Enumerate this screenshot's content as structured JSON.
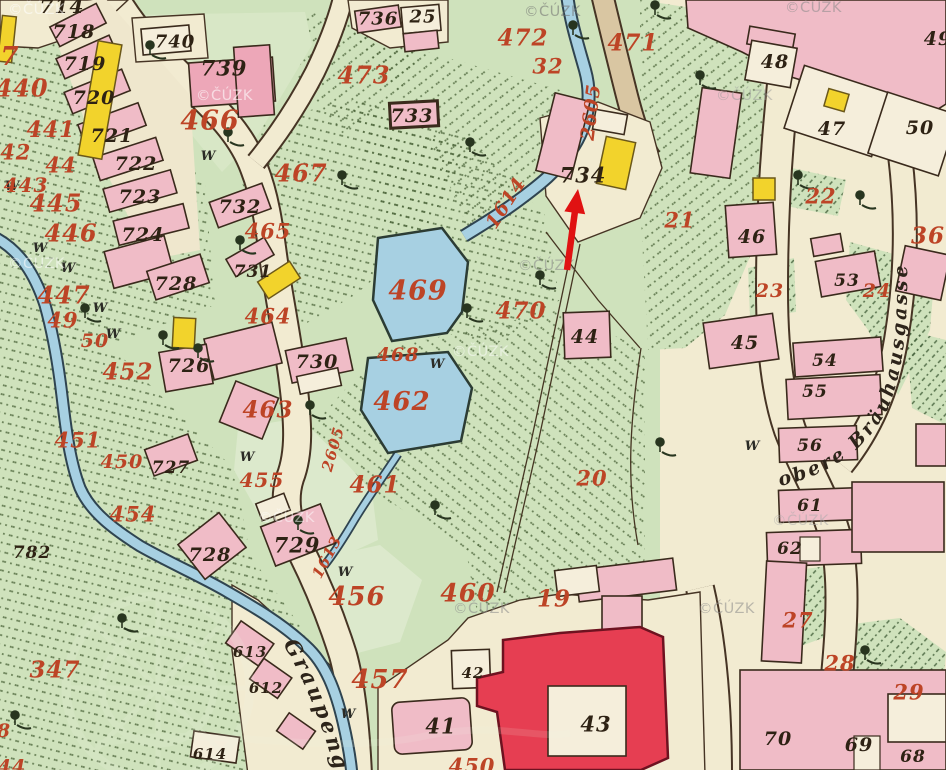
{
  "map": {
    "source_watermark_text": "©ČÚZK",
    "street_names": {
      "graupengasse": "Graupengasse",
      "brauhausgasse": "obere Bräuhausgasse"
    },
    "red_parcel_labels": [
      [
        "7",
        10,
        57,
        26
      ],
      [
        "440",
        22,
        88,
        24
      ],
      [
        "441",
        51,
        130,
        22
      ],
      [
        "442",
        8,
        152,
        21
      ],
      [
        "44",
        61,
        165,
        21
      ],
      [
        "443",
        26,
        185,
        20
      ],
      [
        "445",
        56,
        203,
        24
      ],
      [
        "446",
        71,
        233,
        24
      ],
      [
        "447",
        64,
        295,
        24
      ],
      [
        "49",
        63,
        320,
        21
      ],
      [
        "50",
        95,
        341,
        19
      ],
      [
        "452",
        128,
        372,
        23
      ],
      [
        "451",
        78,
        440,
        21
      ],
      [
        "450",
        122,
        462,
        19
      ],
      [
        "455",
        262,
        480,
        20
      ],
      [
        "454",
        133,
        514,
        21
      ],
      [
        "456",
        357,
        597,
        26
      ],
      [
        "457",
        380,
        680,
        26
      ],
      [
        "460",
        468,
        593,
        25
      ],
      [
        "461",
        375,
        485,
        23
      ],
      [
        "462",
        402,
        402,
        26
      ],
      [
        "463",
        268,
        410,
        23
      ],
      [
        "464",
        268,
        316,
        21
      ],
      [
        "465",
        268,
        231,
        21
      ],
      [
        "466",
        210,
        121,
        27
      ],
      [
        "467",
        301,
        173,
        24
      ],
      [
        "468",
        398,
        355,
        19
      ],
      [
        "469",
        418,
        291,
        27
      ],
      [
        "470",
        521,
        311,
        23
      ],
      [
        "471",
        633,
        43,
        23
      ],
      [
        "472",
        523,
        38,
        23
      ],
      [
        "473",
        364,
        75,
        24
      ],
      [
        "32",
        548,
        66,
        21
      ],
      [
        "2605",
        591,
        112,
        19,
        -83
      ],
      [
        "1614",
        506,
        203,
        19,
        -57
      ],
      [
        "1613",
        327,
        557,
        15,
        -62
      ],
      [
        "2605",
        333,
        449,
        15,
        -74
      ],
      [
        "19",
        554,
        599,
        23
      ],
      [
        "20",
        592,
        478,
        21
      ],
      [
        "21",
        680,
        220,
        21
      ],
      [
        "22",
        821,
        196,
        21
      ],
      [
        "23",
        770,
        291,
        19
      ],
      [
        "24",
        877,
        291,
        19
      ],
      [
        "36",
        928,
        236,
        23
      ],
      [
        "27",
        798,
        620,
        21
      ],
      [
        "28",
        840,
        663,
        21
      ],
      [
        "29",
        909,
        692,
        21
      ],
      [
        "347",
        55,
        670,
        23
      ],
      [
        "450",
        472,
        766,
        21
      ],
      [
        "8",
        4,
        731,
        19
      ],
      [
        "44",
        12,
        767,
        19
      ]
    ],
    "black_house_labels": [
      [
        "714",
        62,
        6,
        20
      ],
      [
        "718",
        74,
        32,
        19
      ],
      [
        "719",
        85,
        64,
        19
      ],
      [
        "720",
        94,
        98,
        19
      ],
      [
        "721",
        112,
        136,
        19
      ],
      [
        "722",
        136,
        164,
        19
      ],
      [
        "723",
        140,
        197,
        19
      ],
      [
        "724",
        143,
        235,
        19
      ],
      [
        "726",
        189,
        366,
        19
      ],
      [
        "727",
        171,
        468,
        17
      ],
      [
        "728",
        176,
        284,
        19
      ],
      [
        "728",
        210,
        555,
        19
      ],
      [
        "739",
        224,
        68,
        21
      ],
      [
        "729",
        297,
        545,
        21
      ],
      [
        "730",
        317,
        362,
        19
      ],
      [
        "731",
        253,
        272,
        17
      ],
      [
        "732",
        240,
        207,
        19
      ],
      [
        "733",
        412,
        116,
        19
      ],
      [
        "734",
        583,
        175,
        21
      ],
      [
        "736",
        378,
        19,
        18
      ],
      [
        "25",
        423,
        17,
        18
      ],
      [
        "740",
        175,
        42,
        18
      ],
      [
        "41",
        441,
        726,
        21
      ],
      [
        "42",
        473,
        673,
        15
      ],
      [
        "43",
        596,
        724,
        21
      ],
      [
        "44",
        585,
        337,
        19
      ],
      [
        "45",
        745,
        343,
        19
      ],
      [
        "46",
        752,
        237,
        19
      ],
      [
        "47",
        832,
        129,
        19
      ],
      [
        "48",
        775,
        62,
        19
      ],
      [
        "49",
        938,
        39,
        19
      ],
      [
        "50",
        920,
        128,
        19
      ],
      [
        "53",
        847,
        281,
        17
      ],
      [
        "54",
        825,
        361,
        17
      ],
      [
        "55",
        815,
        392,
        17
      ],
      [
        "56",
        810,
        446,
        17
      ],
      [
        "61",
        810,
        506,
        17
      ],
      [
        "62",
        790,
        549,
        17
      ],
      [
        "68",
        913,
        757,
        17
      ],
      [
        "69",
        859,
        745,
        19
      ],
      [
        "70",
        778,
        739,
        19
      ],
      [
        "613",
        250,
        652,
        15
      ],
      [
        "612",
        266,
        688,
        15
      ],
      [
        "614",
        210,
        754,
        15
      ],
      [
        "782",
        32,
        553,
        17
      ]
    ],
    "meadow_marks": {
      "letter": "W",
      "positions": [
        [
          12,
          190
        ],
        [
          40,
          252
        ],
        [
          68,
          272
        ],
        [
          100,
          312
        ],
        [
          113,
          338
        ],
        [
          208,
          160
        ],
        [
          247,
          461
        ],
        [
          437,
          368
        ],
        [
          345,
          576
        ],
        [
          348,
          718
        ],
        [
          752,
          450
        ]
      ]
    },
    "trees": [
      [
        150,
        55
      ],
      [
        228,
        142
      ],
      [
        342,
        185
      ],
      [
        470,
        152
      ],
      [
        240,
        250
      ],
      [
        163,
        345
      ],
      [
        198,
        358
      ],
      [
        85,
        318
      ],
      [
        540,
        285
      ],
      [
        467,
        318
      ],
      [
        310,
        415
      ],
      [
        435,
        515
      ],
      [
        298,
        530
      ],
      [
        122,
        628
      ],
      [
        15,
        725
      ],
      [
        660,
        452
      ],
      [
        700,
        85
      ],
      [
        655,
        15
      ],
      [
        573,
        35
      ],
      [
        798,
        185
      ],
      [
        860,
        205
      ],
      [
        865,
        660
      ]
    ],
    "watermarks": [
      [
        8,
        14,
        "#ffffff",
        0.55
      ],
      [
        196,
        100,
        "#ffffff",
        0.6
      ],
      [
        524,
        16,
        "#6f6f6f",
        0.55
      ],
      [
        785,
        12,
        "#8a8a8a",
        0.55
      ],
      [
        716,
        100,
        "#9a9a9a",
        0.5
      ],
      [
        8,
        268,
        "#ffffff",
        0.55
      ],
      [
        452,
        356,
        "#ffffff",
        0.5
      ],
      [
        518,
        270,
        "#8a8a8a",
        0.55
      ],
      [
        258,
        522,
        "#ffffff",
        0.5
      ],
      [
        453,
        613,
        "#8a8a8a",
        0.55
      ],
      [
        698,
        613,
        "#8a8a8a",
        0.55
      ],
      [
        772,
        525,
        "#aaaaaa",
        0.5
      ]
    ],
    "annotation_arrow": {
      "color": "#e01212",
      "tail": [
        567,
        270
      ],
      "tip": [
        578,
        189
      ],
      "shaft_width": 6.5
    },
    "colors": {
      "paper": "#f2ebd1",
      "field_green": "#cfe2bc",
      "field_green_light": "#d8e7c6",
      "building_pink": "#f0bcc7",
      "building_dark_pink": "#eda7b8",
      "building_red": "#e63e52",
      "building_yellow": "#f2d32c",
      "water_blue": "#a7d0e2",
      "road_tan": "#d9c6a2",
      "label_red": "#bd4426",
      "label_black": "#2e2214"
    }
  }
}
